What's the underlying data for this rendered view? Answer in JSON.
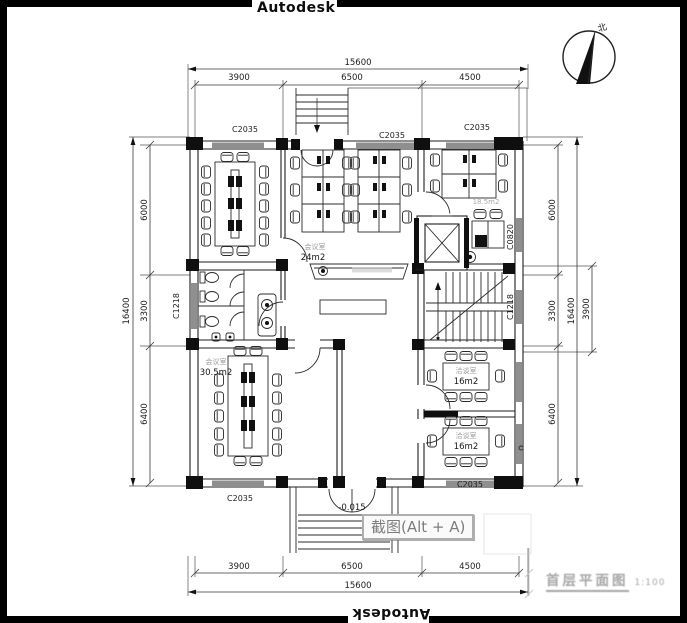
{
  "brand": {
    "top": "Autodesk",
    "bottom": "Autodesk"
  },
  "north_label": "北",
  "dims": {
    "top_total": "15600",
    "top_segments": [
      "3900",
      "6500",
      "4500"
    ],
    "bottom_total": "15600",
    "bottom_segments": [
      "3900",
      "6500",
      "4500"
    ],
    "left_total": "16400",
    "left_segments": [
      "6000",
      "3300",
      "6400"
    ],
    "right_total": "16400",
    "right_segments": [
      "6000",
      "3300",
      "6400"
    ],
    "right_stair": "3900"
  },
  "windows": {
    "top_left": "C2035",
    "top_center": "C2035",
    "top_right": "C2035",
    "bottom_left": "C2035",
    "bottom_right": "C2035",
    "left_mid": "C1218",
    "right_upper": "C0820",
    "right_mid": "C1218"
  },
  "rooms": {
    "meeting_top": {
      "name": "会议室",
      "area": "24m2"
    },
    "meeting_bottom": {
      "name": "会议室",
      "area": "30.5m2"
    },
    "talk_upper": {
      "name": "洽谈室",
      "area": "16m2"
    },
    "talk_lower": {
      "name": "洽谈室",
      "area": "16m2"
    },
    "office_right_area": "18.5m2"
  },
  "entrance_elevation": "-0.015",
  "overlay": {
    "screenshot_button": "截图(Alt + A)"
  },
  "watermark": {
    "title": "首层平面图",
    "scale": "1:100"
  },
  "colors": {
    "line": "#1e1e1e",
    "window_fill": "#8f8f8f",
    "tooltip_border": "#aeaeae",
    "tooltip_text": "#7d7d7d",
    "watermark": "#a6a6a6"
  }
}
